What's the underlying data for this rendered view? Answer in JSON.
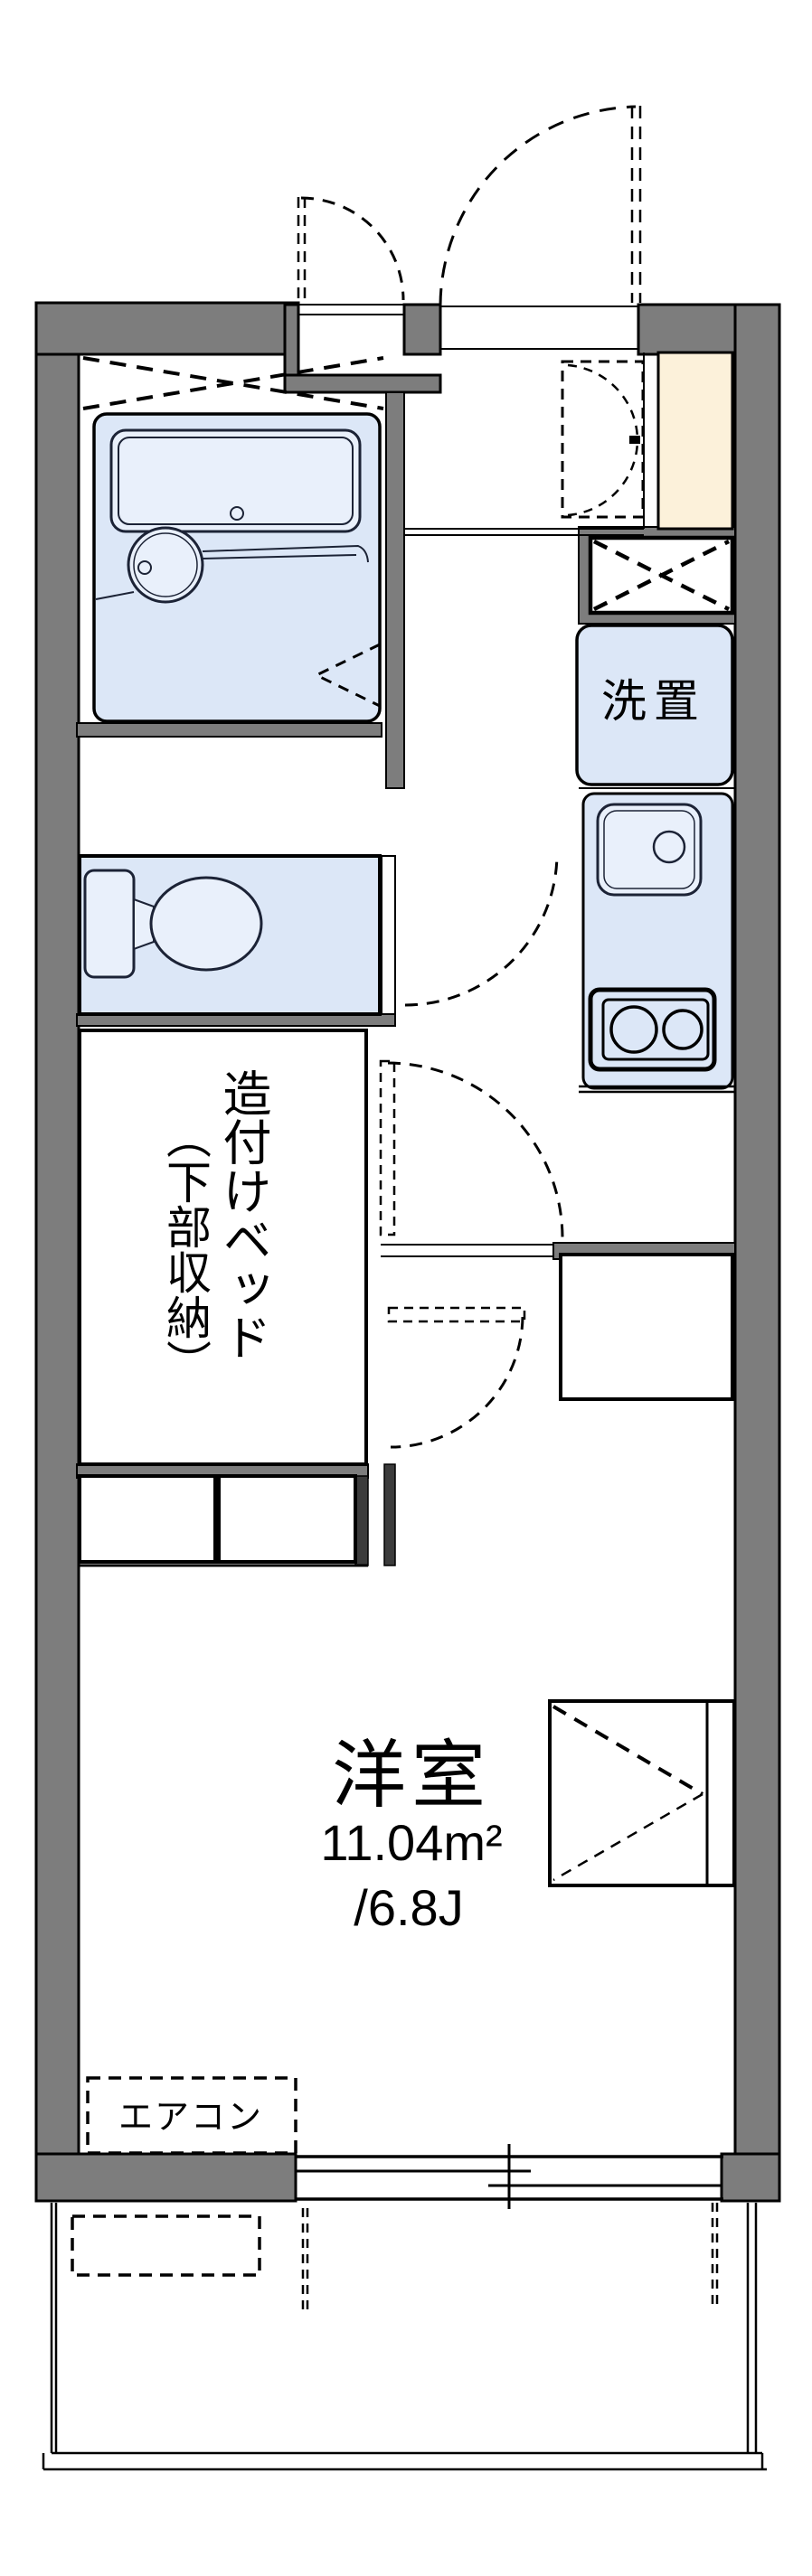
{
  "document": {
    "type": "real-estate floor plan",
    "orientation": "portrait"
  },
  "labels": {
    "washer": "洗置",
    "bed_main": "造付けベッド",
    "bed_sub": "（下部収納）",
    "room_name": "洋室",
    "room_area": "11.04m²",
    "room_tatami": "/6.8J",
    "aircon": "エアコン"
  },
  "colors": {
    "wall": "#7d7d7d",
    "outline": "#000000",
    "fixture_line": "#1c2336",
    "water_area_fill": "#dce7f7",
    "fixture_fill": "#e9f0fb",
    "genkan_floor": "#fcf1da",
    "background": "#ffffff"
  }
}
